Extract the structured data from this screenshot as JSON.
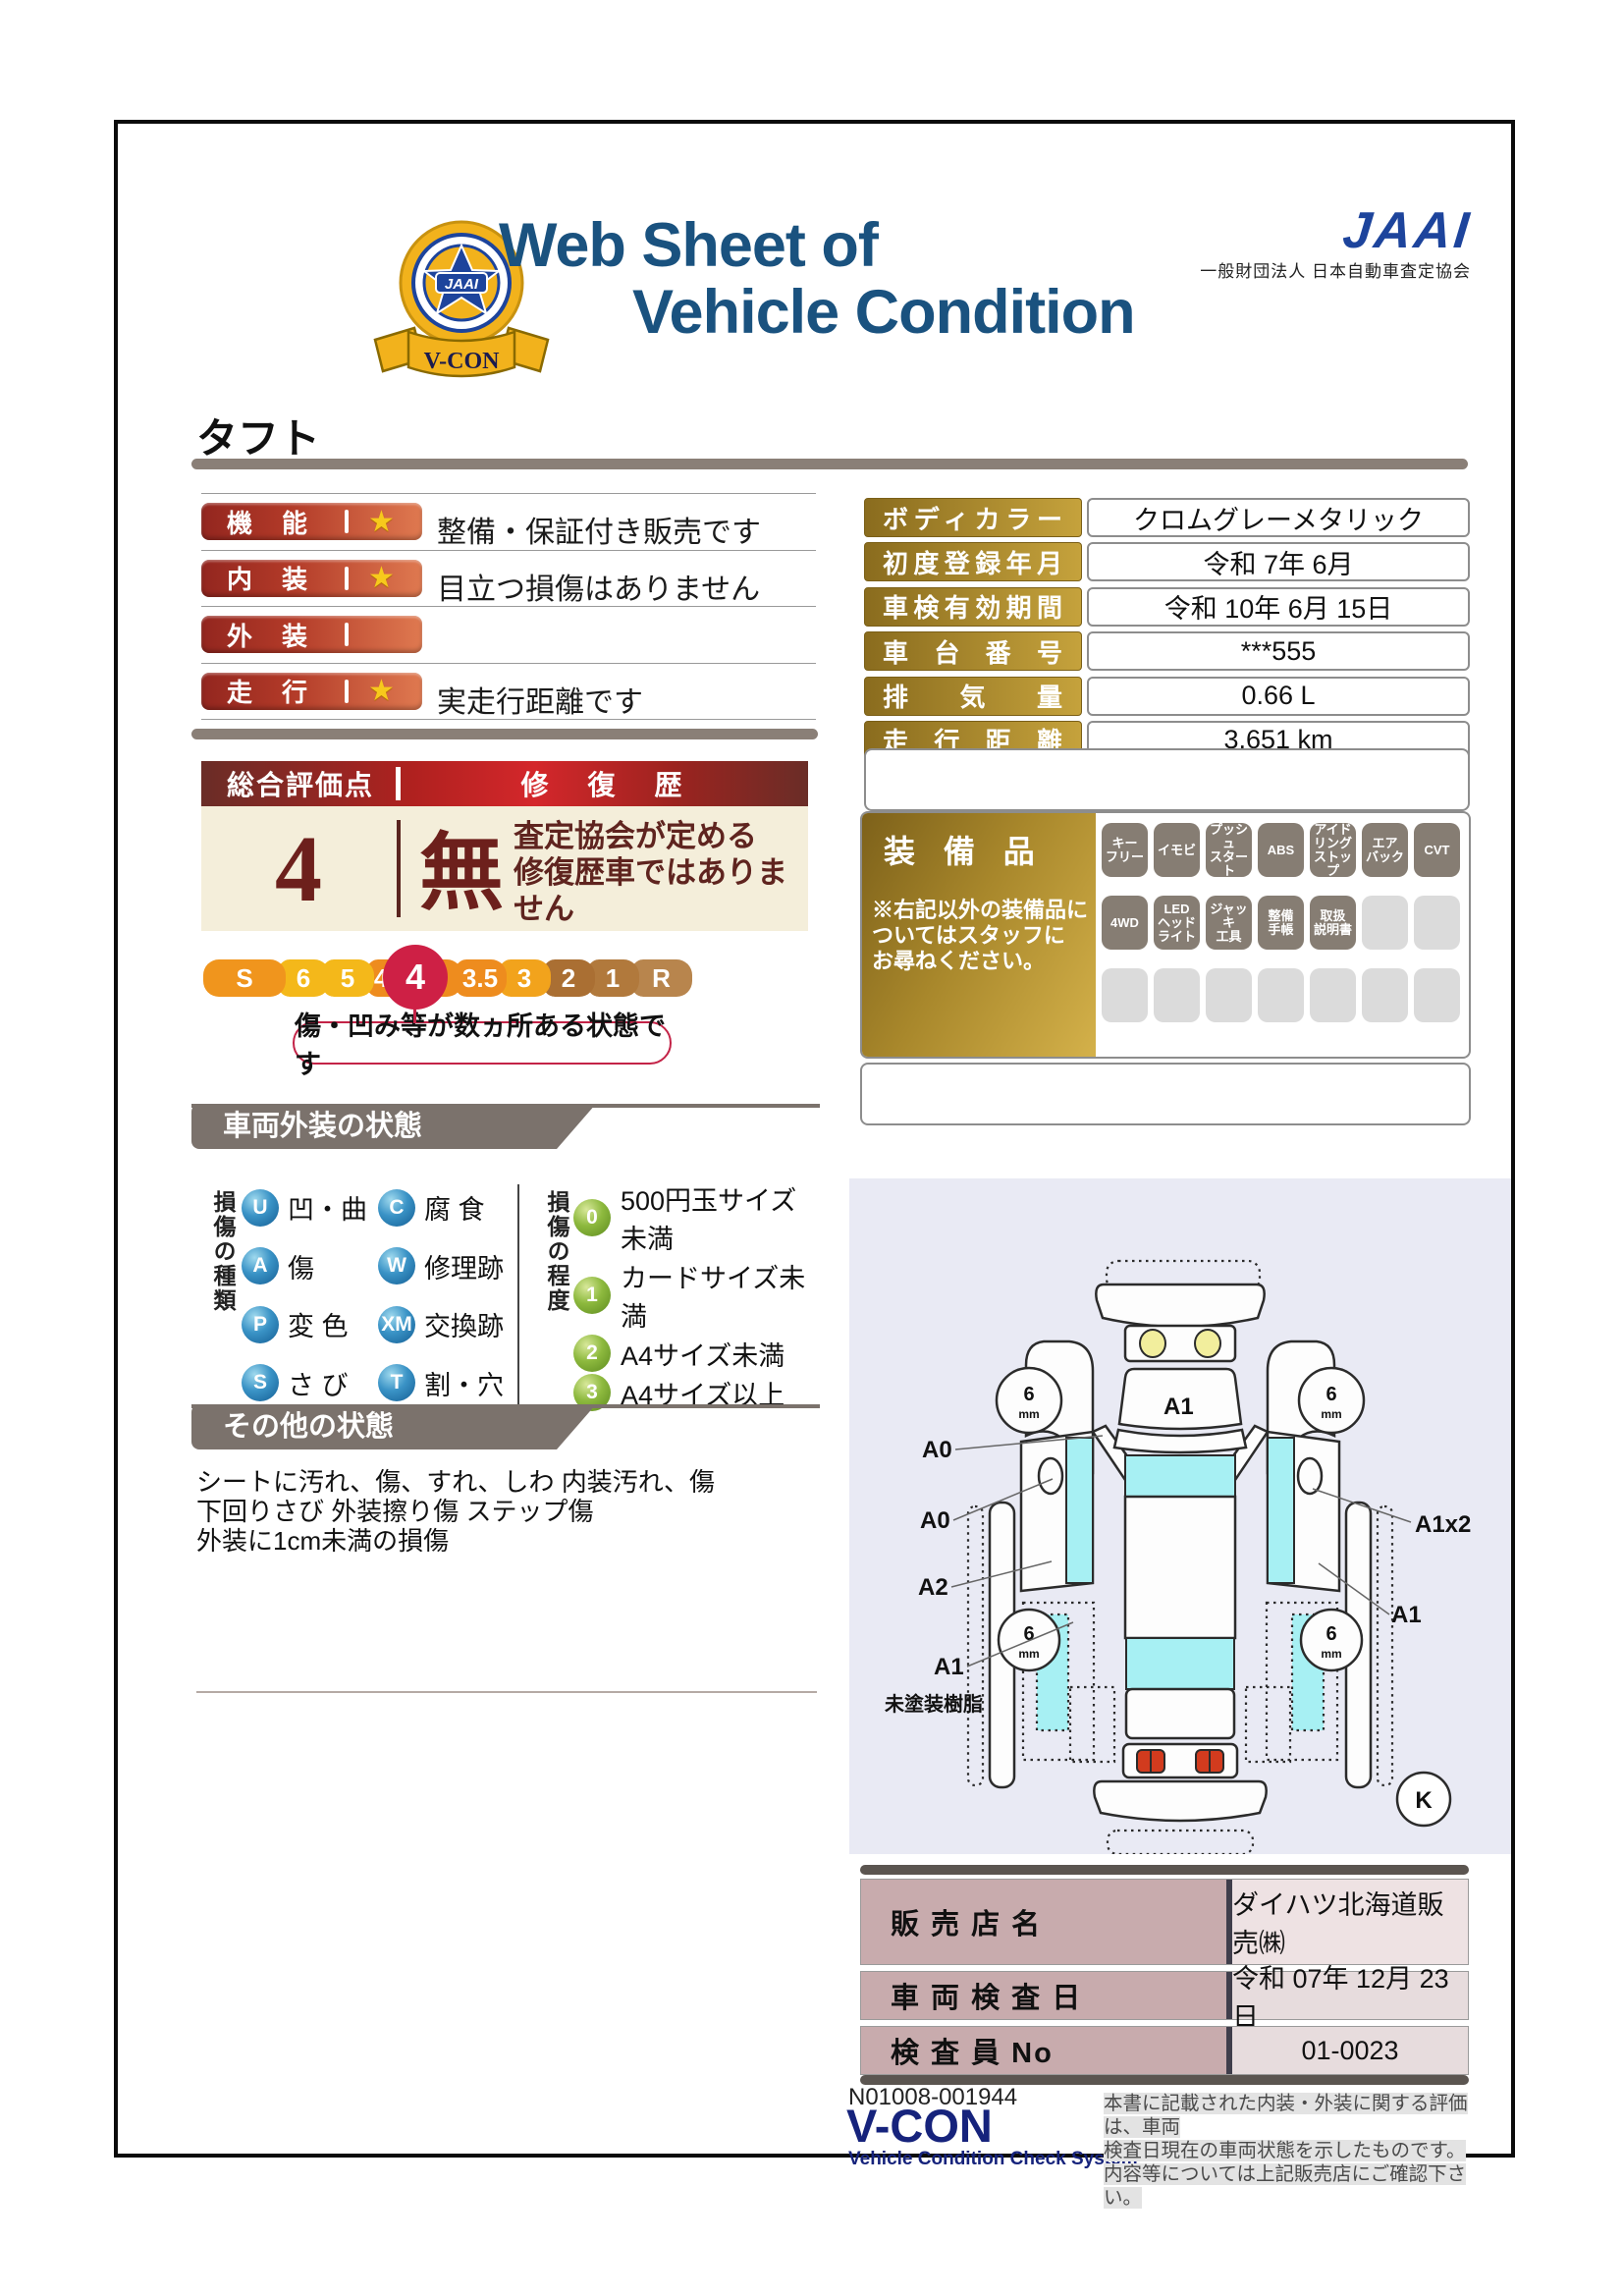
{
  "palette": {
    "title_navy": "#1a527f",
    "jaai_blue": "#1d449c",
    "rating_bar_left": "#93261f",
    "rating_bar_right": "#df7950",
    "star_gold": "#f7c91c",
    "gold_label_dark": "#8a6c1e",
    "gold_label_light": "#c5a23c",
    "score_maroon": "#6a2d27",
    "score_red": "#d4272b",
    "cream": "#f4eeda",
    "scale_selected": "#ce2045",
    "banner_gray": "#7b726c",
    "sphere_blue": "#135d93",
    "sphere_green": "#5c8a1e",
    "badge_on": "#867d73",
    "badge_off": "#dbdbdb",
    "dealer_label": "#c8abad",
    "dealer_value": "#e7dcdd",
    "diagram_bg": "#e9eaf4",
    "diagram_cyan": "#a7f0f3",
    "vcon_navy": "#16237c"
  },
  "header": {
    "badge_center": "JAAI",
    "badge_ribbon": "V-CON",
    "title_line1": "Web Sheet of",
    "title_line2": "Vehicle Condition",
    "jaai_logo": "JAAI",
    "jaai_org": "一般財団法人 日本自動車査定協会"
  },
  "vehicle_name": "タフト",
  "ratings": [
    {
      "label": "機　能",
      "star": "★",
      "note": "整備・保証付き販売です"
    },
    {
      "label": "内　装",
      "star": "★",
      "note": "目立つ損傷はありません"
    },
    {
      "label": "外　装",
      "star": "",
      "note": ""
    },
    {
      "label": "走　行",
      "star": "★",
      "note": "実走行距離です"
    }
  ],
  "score": {
    "header_left": "総合評価点",
    "header_right": "修　復　歴",
    "value": "4",
    "repair_mark": "無",
    "repair_note1": "査定協会が定める",
    "repair_note2": "修復歴車ではありません"
  },
  "scale": {
    "items": [
      "S",
      "6",
      "5",
      "4.5",
      "4",
      "3.5",
      "3",
      "2",
      "1",
      "R"
    ],
    "selected": "4",
    "callout": "傷・凹み等が数ヵ所ある状態です"
  },
  "details": {
    "rows": [
      {
        "label": "ボディカラー",
        "value": "クロムグレーメタリック"
      },
      {
        "label": "初度登録年月",
        "value": "令和 7年 6月"
      },
      {
        "label": "車検有効期間",
        "value": "令和 10年 6月 15日"
      },
      {
        "label": "車 台 番 号",
        "value": "***555"
      },
      {
        "label": "排 気 量",
        "value": "0.66 L"
      },
      {
        "label": "走 行 距 離",
        "value": "3,651 km"
      }
    ]
  },
  "equipment": {
    "title": "装 備 品",
    "note": "※右記以外の装備品に\nついてはスタッフに\nお尋ねください。",
    "badges": [
      {
        "text": "キー\nフリー",
        "state": "on"
      },
      {
        "text": "イモビ",
        "state": "on"
      },
      {
        "text": "プッシュ\nスタート",
        "state": "on"
      },
      {
        "text": "ABS",
        "state": "on"
      },
      {
        "text": "アイド\nリング\nストップ",
        "state": "on"
      },
      {
        "text": "エア\nバック",
        "state": "on"
      },
      {
        "text": "CVT",
        "state": "on"
      },
      {
        "text": "4WD",
        "state": "on"
      },
      {
        "text": "LED\nヘッド\nライト",
        "state": "on"
      },
      {
        "text": "ジャッキ\n工具",
        "state": "on"
      },
      {
        "text": "整備\n手帳",
        "state": "on"
      },
      {
        "text": "取扱\n説明書",
        "state": "on"
      },
      {
        "text": "",
        "state": "off"
      },
      {
        "text": "",
        "state": "off"
      },
      {
        "text": "",
        "state": "off"
      },
      {
        "text": "",
        "state": "off"
      },
      {
        "text": "",
        "state": "off"
      },
      {
        "text": "",
        "state": "off"
      },
      {
        "text": "",
        "state": "off"
      },
      {
        "text": "",
        "state": "off"
      },
      {
        "text": "",
        "state": "off"
      }
    ]
  },
  "exterior": {
    "title": "車両外装の状態",
    "kind_title": "損傷の種類",
    "kinds": [
      {
        "code": "U",
        "label": "凹・曲"
      },
      {
        "code": "C",
        "label": "腐 食"
      },
      {
        "code": "A",
        "label": "傷"
      },
      {
        "code": "W",
        "label": "修理跡"
      },
      {
        "code": "P",
        "label": "変 色"
      },
      {
        "code": "XM",
        "label": "交換跡"
      },
      {
        "code": "S",
        "label": "さ び"
      },
      {
        "code": "T",
        "label": "割・穴"
      }
    ],
    "degree_title": "損傷の程度",
    "degrees": [
      {
        "code": "0",
        "label": "500円玉サイズ未満"
      },
      {
        "code": "1",
        "label": "カードサイズ未満"
      },
      {
        "code": "2",
        "label": "A4サイズ未満"
      },
      {
        "code": "3",
        "label": "A4サイズ以上"
      }
    ]
  },
  "other": {
    "title": "その他の状態",
    "lines": [
      "シートに汚れ、傷、すれ、しわ 内装汚れ、傷",
      "下回りさび 外装擦り傷 ステップ傷",
      "外装に1cm未満の損傷"
    ]
  },
  "diagram": {
    "hood_label": "A1",
    "label_a0_1": "A0",
    "label_a0_2": "A0",
    "label_a2": "A2",
    "label_a1_left": "A1",
    "label_resin": "未塗装樹脂",
    "label_a1x2": "A1x2",
    "label_a1_right": "A1",
    "wheel_value": "6",
    "wheel_unit": "mm",
    "corner_mark": "K"
  },
  "dealer": {
    "rows": [
      {
        "label": "販 売 店 名",
        "value": "ダイハツ北海道販売㈱"
      },
      {
        "label": "車 両 検 査 日",
        "value": "令和 07年 12月 23日"
      },
      {
        "label": "検 査 員 No",
        "value": "01-0023"
      }
    ]
  },
  "footer": {
    "doc_no": "N01008-001944",
    "vcon": "V-CON",
    "vcon_sub": "Vehicle Condition Check System",
    "note_lines": [
      "本書に記載された内装・外装に関する評価は、車両",
      "検査日現在の車両状態を示したものです。",
      "内容等については上記販売店にご確認下さい。"
    ]
  }
}
